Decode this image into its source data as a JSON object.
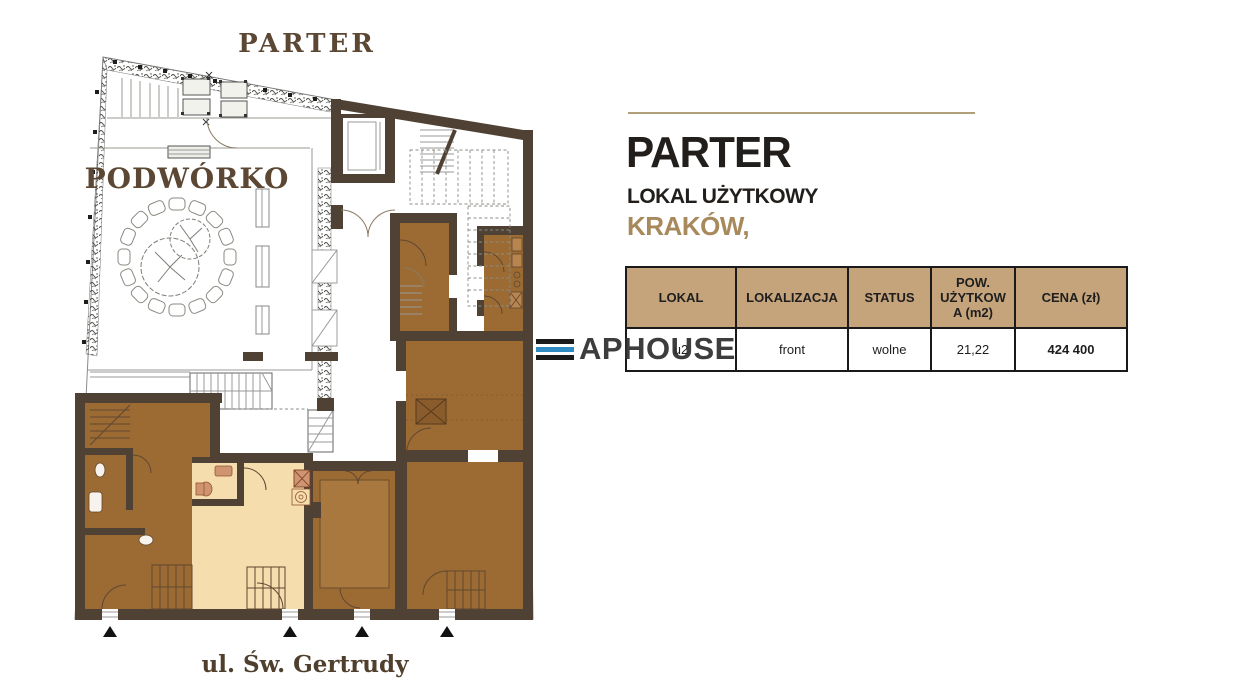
{
  "plan": {
    "title": "PARTER",
    "courtyard_label": "PODWÓRKO",
    "street_label": "ul. Św. Gertrudy",
    "colors": {
      "wall": "#4f4134",
      "room_brown": "#9c6b33",
      "room_inner": "#a9783f",
      "unit_highlight": "#f5ddae",
      "fixture": "#cf9472",
      "label": "#5b4733"
    }
  },
  "panel": {
    "heading": "PARTER",
    "subheading": "LOKAL UŻYTKOWY",
    "city": "KRAKÓW,",
    "accent_color": "#a8895b",
    "rule_color": "#b09f7a",
    "table": {
      "header_bg": "#c5a47c",
      "columns": [
        "LOKAL",
        "LOKALIZACJA",
        "STATUS",
        "POW. UŻYTKOWA (m2)",
        "CENA (zł)"
      ],
      "rows": [
        {
          "lokal": "u2",
          "lokalizacja": "front",
          "status": "wolne",
          "pow_uzytkowa_m2": "21,22",
          "cena_zl": "424 400"
        }
      ]
    }
  },
  "watermark": {
    "text": "APHOUSE",
    "bar_color_top": "#1b1b1b",
    "bar_color_middle": "#2e8cc3",
    "bar_color_bottom": "#1b1b1b"
  }
}
